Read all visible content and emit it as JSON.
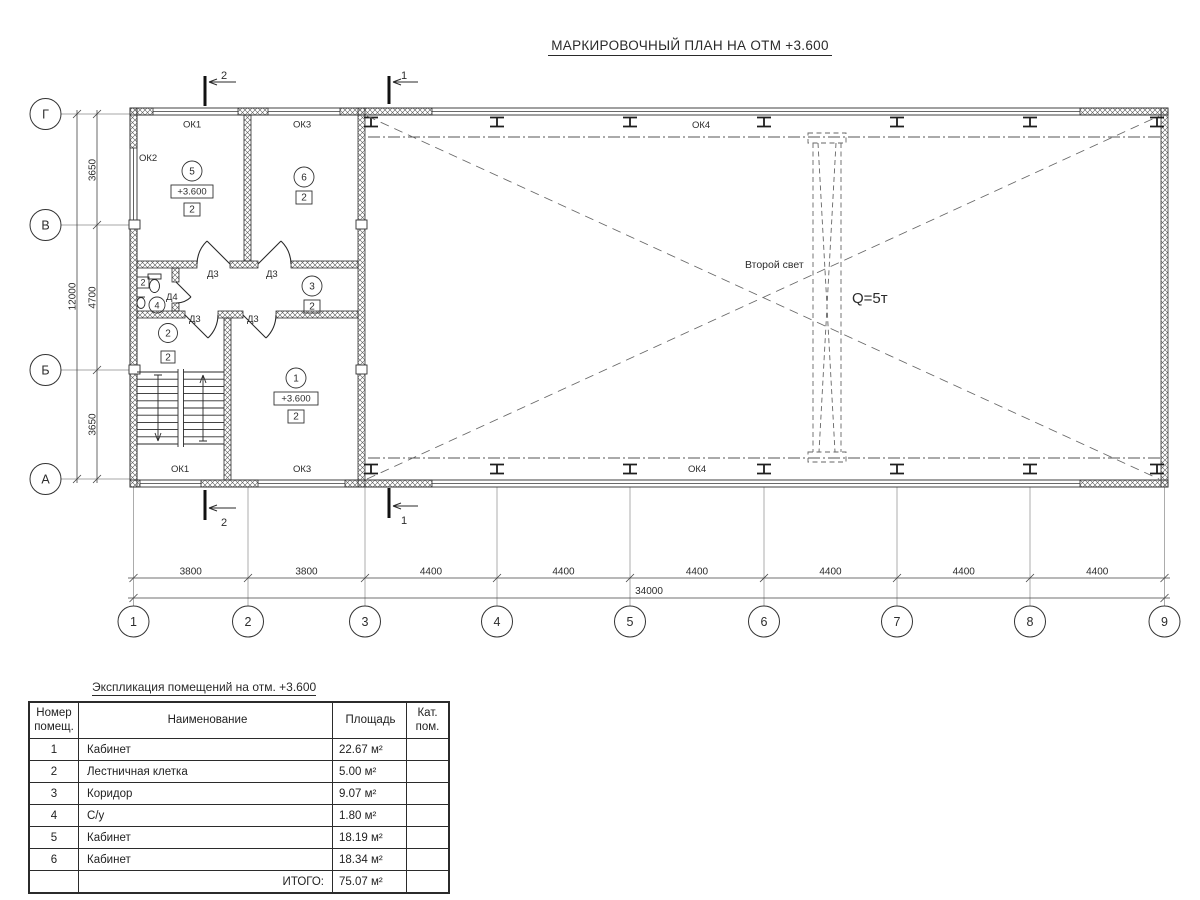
{
  "title": "МАРКИРОВОЧНЫЙ ПЛАН НА ОТМ +3.600",
  "plan": {
    "axes_h": [
      "1",
      "2",
      "3",
      "4",
      "5",
      "6",
      "7",
      "8",
      "9"
    ],
    "axes_v": [
      "Г",
      "В",
      "Б",
      "А"
    ],
    "dims_bottom": [
      "3800",
      "3800",
      "4400",
      "4400",
      "4400",
      "4400",
      "4400",
      "4400"
    ],
    "dim_total_bottom": "34000",
    "dims_left": [
      "3650",
      "4700",
      "3650"
    ],
    "dim_total_left": "12000",
    "windows": {
      "ok1": "ОК1",
      "ok2": "ОК2",
      "ok3": "ОК3",
      "ok4": "ОК4"
    },
    "doors": {
      "d3": "Д3",
      "d4": "Д4"
    },
    "labels": {
      "second_light": "Второй свет",
      "crane": "Q=5т"
    },
    "sections": {
      "s1": "1",
      "s2": "2"
    },
    "rooms": {
      "r1": {
        "num": "1",
        "elev": "+3.600",
        "cat": "2"
      },
      "r2": {
        "num": "2",
        "cat": "2"
      },
      "r3": {
        "num": "3",
        "cat": "2"
      },
      "r4": {
        "num": "4",
        "cat": "2"
      },
      "r5": {
        "num": "5",
        "elev": "+3.600",
        "cat": "2"
      },
      "r6": {
        "num": "6",
        "cat": "2"
      }
    }
  },
  "table": {
    "title": "Экспликация помещений на отм. +3.600",
    "headers": {
      "num": [
        "Номер",
        "помещ."
      ],
      "name": "Наименование",
      "area": "Площадь",
      "cat": [
        "Кат.",
        "пом."
      ]
    },
    "rows": [
      [
        "1",
        "Кабинет",
        "22.67 м²",
        ""
      ],
      [
        "2",
        "Лестничная клетка",
        "5.00 м²",
        ""
      ],
      [
        "3",
        "Коридор",
        "9.07 м²",
        ""
      ],
      [
        "4",
        "С/у",
        "1.80 м²",
        ""
      ],
      [
        "5",
        "Кабинет",
        "18.19 м²",
        ""
      ],
      [
        "6",
        "Кабинет",
        "18.34 м²",
        ""
      ]
    ],
    "total_label": "ИТОГО:",
    "total_value": "75.07 м²"
  },
  "colors": {
    "line": "#2c2c2c",
    "hatch": "#5a5a5a"
  }
}
